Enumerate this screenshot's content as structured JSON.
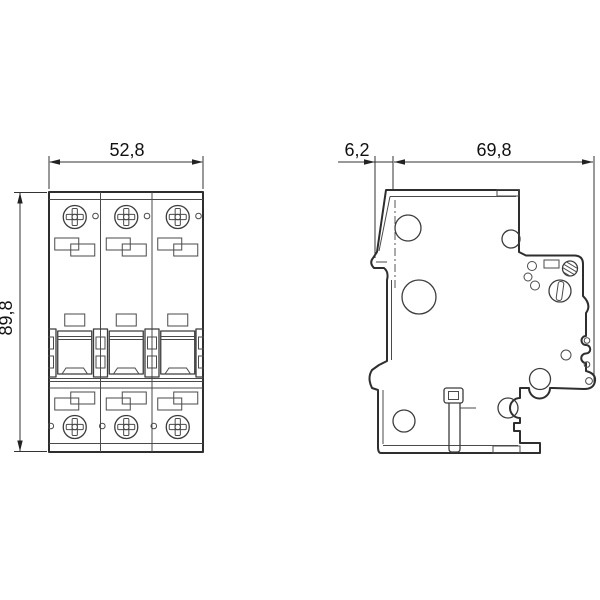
{
  "drawing": {
    "kind": "circuit-breaker dimension drawing",
    "colors": {
      "background": "#ffffff",
      "line": "#2e2e2e",
      "dimension": "#111111"
    },
    "front_view": {
      "dim_width": "52,8",
      "dim_height": "89,8"
    },
    "side_view": {
      "dim_offset": "6,2",
      "dim_depth": "69,8"
    }
  }
}
